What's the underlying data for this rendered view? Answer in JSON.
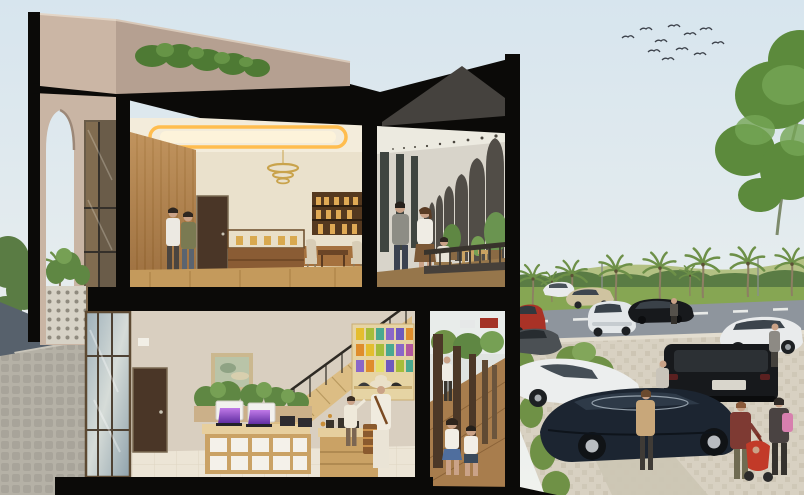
{
  "meta": {
    "type": "architectural-rendering",
    "subject": "Cross-section of a two-story shophouse: cafe with arched balcony corridor upstairs, retail store with staircase below, palm-lined parking lot and street at right"
  },
  "palette": {
    "sky_top": "#d7e5ee",
    "sky_bottom": "#f0f2ee",
    "cut_black": "#0b0a08",
    "parapet": "#c9b5a4",
    "parapet_side": "#b5a091",
    "roof_gray": "#45423e",
    "shrub_green": "#4e7a34",
    "ceiling_cream": "#f3ecdb",
    "cove_glow": "#ffbd4f",
    "wood_wall": "#b68753",
    "back_wall": "#eae1cc",
    "wood_floor": "#c49a5c",
    "door_brown": "#4a3627",
    "arch_dark": "#514d47",
    "corridor_ceiling": "#eceae0",
    "railing_dark": "#38332c",
    "gf_wall": "#d9cfc0",
    "stair_wood": "#dcbd84",
    "counter_wood": "#caa265",
    "shelf_wood": "#e6d4a4",
    "tile_floor": "#ece5d6",
    "arcade_floor": "#a87d4d",
    "column_brown": "#4c3827",
    "asphalt": "#57616c",
    "sidewalk": "#b5b1a6",
    "parking_paver": "#d8d1c2",
    "walkway": "#ccc5b4",
    "lawn": "#86a653",
    "treeline": "#5a7c44",
    "hills": "#b3c183",
    "palm_green": "#6d9048",
    "palm_trunk": "#8d7f63",
    "tree_green": "#5c8a3c",
    "car_white": "#e9ebec",
    "car_black": "#17191c",
    "car_navy": "#1c2531",
    "car_red": "#a93226",
    "car_beige": "#cfc3a0",
    "car_gray": "#4b5054",
    "screen_purple": "#8b4fd0",
    "bird": "#3c414a",
    "skin": "#caa287"
  },
  "scene": {
    "sky": {
      "bird_count": 11
    },
    "building": {
      "roof": [
        "beige parapet",
        "rooftop shrubs",
        "black section cut",
        "gray roof plane"
      ],
      "upper_floor_cafe": [
        "cove-lit ceiling",
        "gold ring chandelier",
        "wood panel wall",
        "entry door",
        "wall shelf with jars",
        "display counter",
        "tables and beige chairs",
        "two patrons walking",
        "section-cut wall",
        "balcony corridor with pointed arches",
        "downlights",
        "strolling couple",
        "seated guest",
        "potted plants",
        "slat railing"
      ],
      "ground_floor_retail": [
        "glass storefront",
        "dark entry door",
        "framed painting",
        "staircase with black railing",
        "under-stair planter",
        "display table with laptops and tablets",
        "white monitors",
        "colorful product shelf",
        "hat display",
        "shopkeeper with hat and satchel",
        "child at counter",
        "coffee counter",
        "arcade walkway with brown columns",
        "two children running",
        "man walking in arcade"
      ]
    },
    "street": {
      "vehicles": [
        "red hatchback",
        "dark gray car",
        "white hatchback",
        "beige sedan",
        "white SUV",
        "black sedan",
        "white coupe",
        "black SUV rear",
        "white sports car",
        "navy sedan"
      ],
      "people": [
        "pedestrian by black sedan",
        "pedestrian by white coupe",
        "pedestrian behind navy sedan",
        "woman in tan coat",
        "woman in maroon jacket pushing red stroller",
        "toddler in stroller",
        "woman with pink backpack"
      ],
      "landscape": [
        "flock of birds",
        "large tree",
        "row of palm trees",
        "distant hills and treeline",
        "lawn",
        "asphalt road with lane dashes",
        "paver parking lot",
        "diagonal walkway",
        "cobblestone sidewalk",
        "hedges and planting"
      ]
    }
  }
}
